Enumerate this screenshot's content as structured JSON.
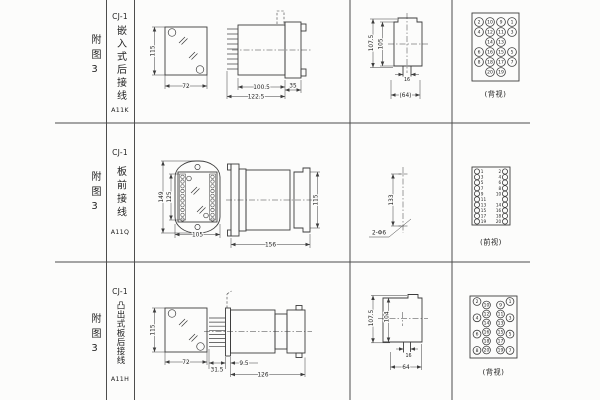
{
  "rows": [
    {
      "figure": "附图3",
      "model": "CJ-1",
      "mount_type": "嵌入式后接线",
      "code": "A11K",
      "dims": {
        "front_height": "115",
        "front_width": "72",
        "body_length": "100.5",
        "total_length": "122.5",
        "flange_depth": "35",
        "cutout_outer_height": "107.5",
        "cutout_inner_height": "105",
        "slot_width": "16",
        "slot_span": "(64)"
      },
      "terminal_view": {
        "label": "(背视)",
        "rows": [
          [
            "2",
            "10",
            "9",
            "1"
          ],
          [
            "4",
            "12",
            "11",
            "3"
          ],
          [
            "14",
            "13"
          ],
          [
            "6",
            "16",
            "15",
            "5"
          ],
          [
            "8",
            "18",
            "17",
            "7"
          ],
          [
            "20",
            "19"
          ]
        ]
      }
    },
    {
      "figure": "附图3",
      "model": "CJ-1",
      "mount_type": "板前接线",
      "code": "A11Q",
      "dims": {
        "flange_height": "149",
        "terminal_strip_height": "125",
        "flange_width": "105",
        "total_length": "156",
        "body_height": "115",
        "hole_pitch": "133",
        "hole_spec": "2-Φ6"
      },
      "terminal_view": {
        "label": "(前视)",
        "left": [
          "1",
          "3",
          "5",
          "7",
          "9",
          "11",
          "13",
          "15",
          "17",
          "19"
        ],
        "right": [
          "2",
          "4",
          "6",
          "8",
          "10",
          "12",
          "14",
          "16",
          "18",
          "20"
        ]
      }
    },
    {
      "figure": "附图3",
      "model": "CJ-1",
      "mount_type": "凸出式板后接线",
      "code": "A11H",
      "dims": {
        "front_height": "115",
        "front_width": "72",
        "pin_length": "31.5",
        "panel_offset": "9.5",
        "body_length": "126",
        "cutout_outer_height": "107.5",
        "cutout_inner_height": "104",
        "slot_width": "16",
        "slot_span": "64"
      },
      "terminal_view": {
        "label": "(背视)",
        "outer_left": [
          "2",
          "4",
          "6",
          "8"
        ],
        "inner_left": [
          "10",
          "12",
          "14",
          "16",
          "18",
          "20"
        ],
        "inner_right": [
          "9",
          "11",
          "13",
          "15",
          "17",
          "19"
        ],
        "outer_right": [
          "1",
          "3",
          "5",
          "7"
        ]
      }
    }
  ]
}
